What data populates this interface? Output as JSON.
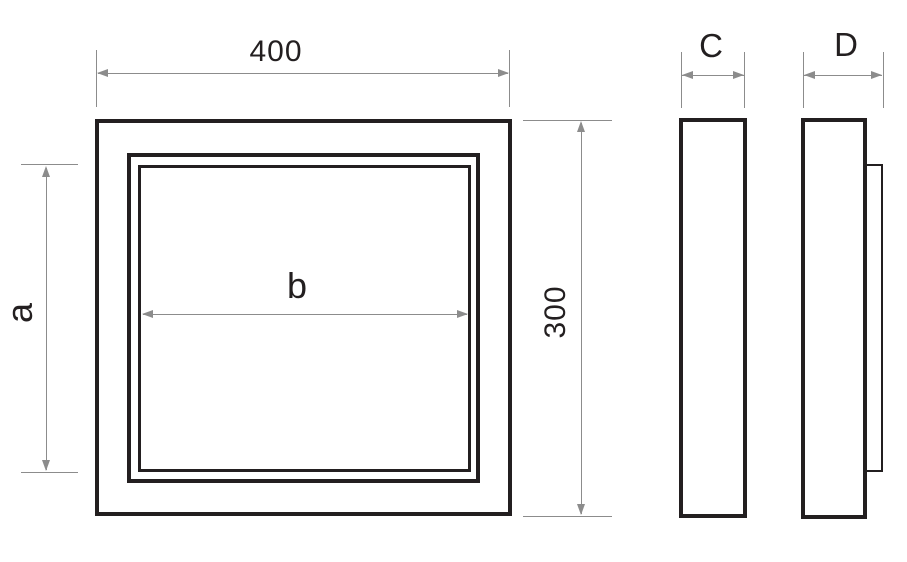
{
  "colors": {
    "drawing_line": "#231f20",
    "dimension_line": "#8c8c8c",
    "background": "#ffffff"
  },
  "dimensions": {
    "overall_width": "400",
    "overall_height": "300",
    "opening_height": "a",
    "opening_width": "b",
    "frame_depth": "C",
    "total_depth": "D"
  }
}
